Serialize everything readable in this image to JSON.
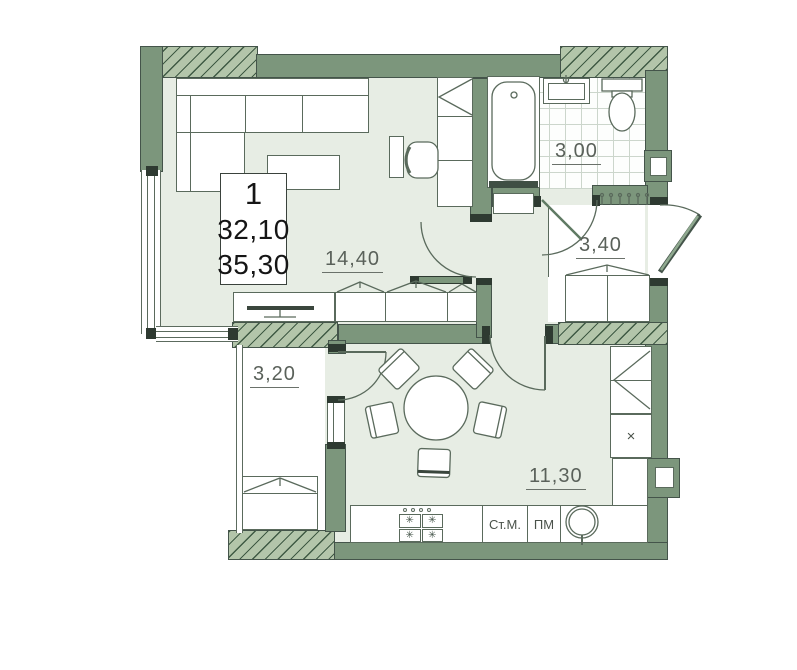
{
  "plan": {
    "unit": {
      "number": "1",
      "living_area": "32,10",
      "total_area": "35,30"
    },
    "rooms": [
      {
        "name": "living-room",
        "area": "14,40"
      },
      {
        "name": "bathroom",
        "area": "3,00"
      },
      {
        "name": "hallway",
        "area": "3,40"
      },
      {
        "name": "balcony",
        "area": "3,20"
      },
      {
        "name": "kitchen",
        "area": "11,30"
      }
    ],
    "labels": {
      "washing_machine": "Ст.М.",
      "dishwasher": "ПМ",
      "cabinet_mark": "×"
    },
    "icons": {
      "stove_burner": "✳"
    },
    "colors": {
      "wall_fill": "#7c967c",
      "wall_outline": "#44544a",
      "hatch_fill": "#b3c5aa",
      "floor_tint": "#e7ede4",
      "line": "#5a6a5c"
    }
  }
}
